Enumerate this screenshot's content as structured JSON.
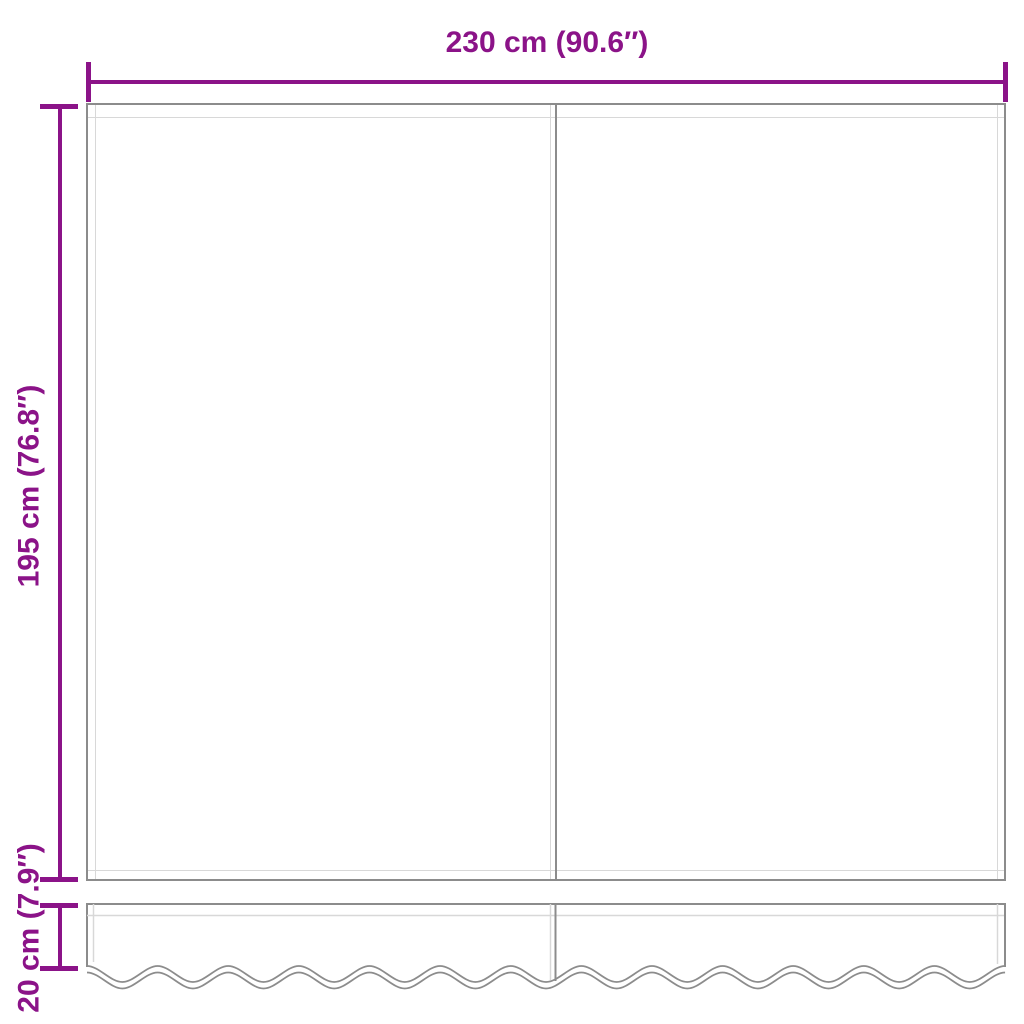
{
  "diagram_title": "Awning replacement fabric dimension diagram",
  "dimensions": {
    "width": {
      "label": "230 cm (90.6″)",
      "value_cm": 230,
      "value_in": 90.6
    },
    "height": {
      "label": "195 cm (76.8″)",
      "value_cm": 195,
      "value_in": 76.8
    },
    "valance": {
      "label": "20 cm (7.9″)",
      "value_cm": 20,
      "value_in": 7.9
    }
  },
  "colors": {
    "dimension": "#8B1388",
    "outline": "#8C8C8C",
    "seam": "#D8D8D8",
    "background": "#ffffff"
  }
}
